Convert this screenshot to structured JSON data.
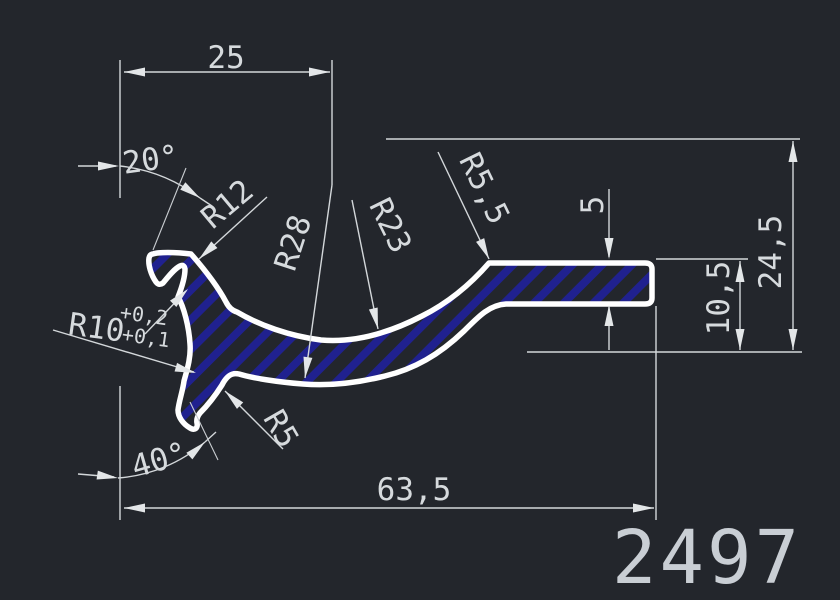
{
  "canvas": {
    "background": "#23262c",
    "line_color": "#d3d7da",
    "profile_outline_color": "#ffffff",
    "hatch_color": "#20218f",
    "part_number_color": "#c9ced4"
  },
  "labels": {
    "top_width": "25",
    "angle_top": "20°",
    "radius_r12": "R12",
    "radius_r28": "R28",
    "radius_r23": "R23",
    "radius_r55": "R5,5",
    "thickness": "5",
    "height_total": "24,5",
    "height_step": "10,5",
    "radius_r10": "R10",
    "r10_tol_upper": "+0,2",
    "r10_tol_lower": "+0,1",
    "radius_r5": "R5",
    "angle_bottom": "40°",
    "bottom_length": "63,5"
  },
  "part_number": "2497"
}
